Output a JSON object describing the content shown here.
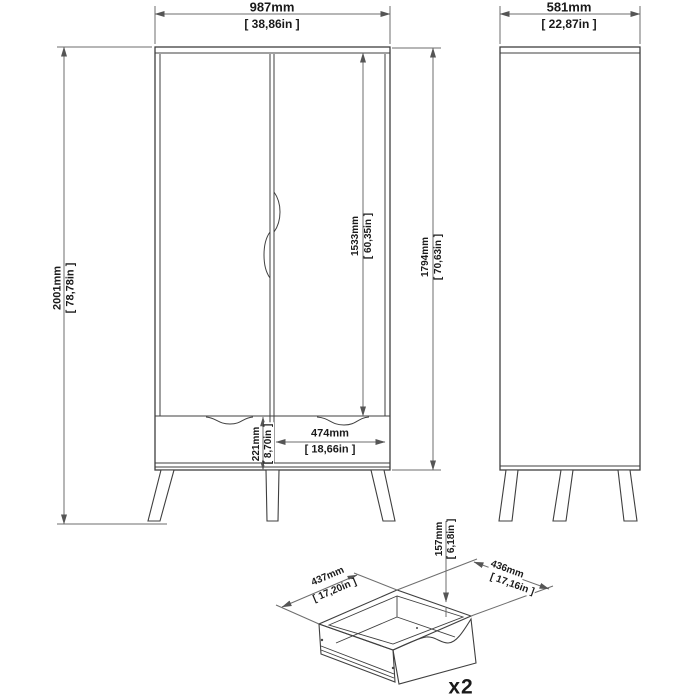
{
  "colors": {
    "background": "#ffffff",
    "object_line": "#3f3f3f",
    "dimension_line": "#6e6e6e",
    "text": "#1a1a1a"
  },
  "dimensions": {
    "front_view": {
      "width": {
        "mm": "987mm",
        "in": "[ 38,86in ]"
      },
      "total_height": {
        "mm": "2001mm",
        "in": "[ 78,78in ]"
      },
      "door_height": {
        "mm": "1533mm",
        "in": "[ 60,35in ]"
      },
      "carcass_height": {
        "mm": "1794mm",
        "in": "[ 70,63in ]"
      },
      "drawer_front_height": {
        "mm": "221mm",
        "in": "[ 8,70in ]"
      },
      "drawer_front_width": {
        "mm": "474mm",
        "in": "[ 18,66in ]"
      }
    },
    "side_view": {
      "depth": {
        "mm": "581mm",
        "in": "[ 22,87in ]"
      }
    },
    "drawer_detail": {
      "depth": {
        "mm": "437mm",
        "in": "[ 17,20in ]"
      },
      "width": {
        "mm": "436mm",
        "in": "[ 17,16in ]"
      },
      "height": {
        "mm": "157mm",
        "in": "[ 6,18in ]"
      },
      "quantity": "x2"
    }
  }
}
